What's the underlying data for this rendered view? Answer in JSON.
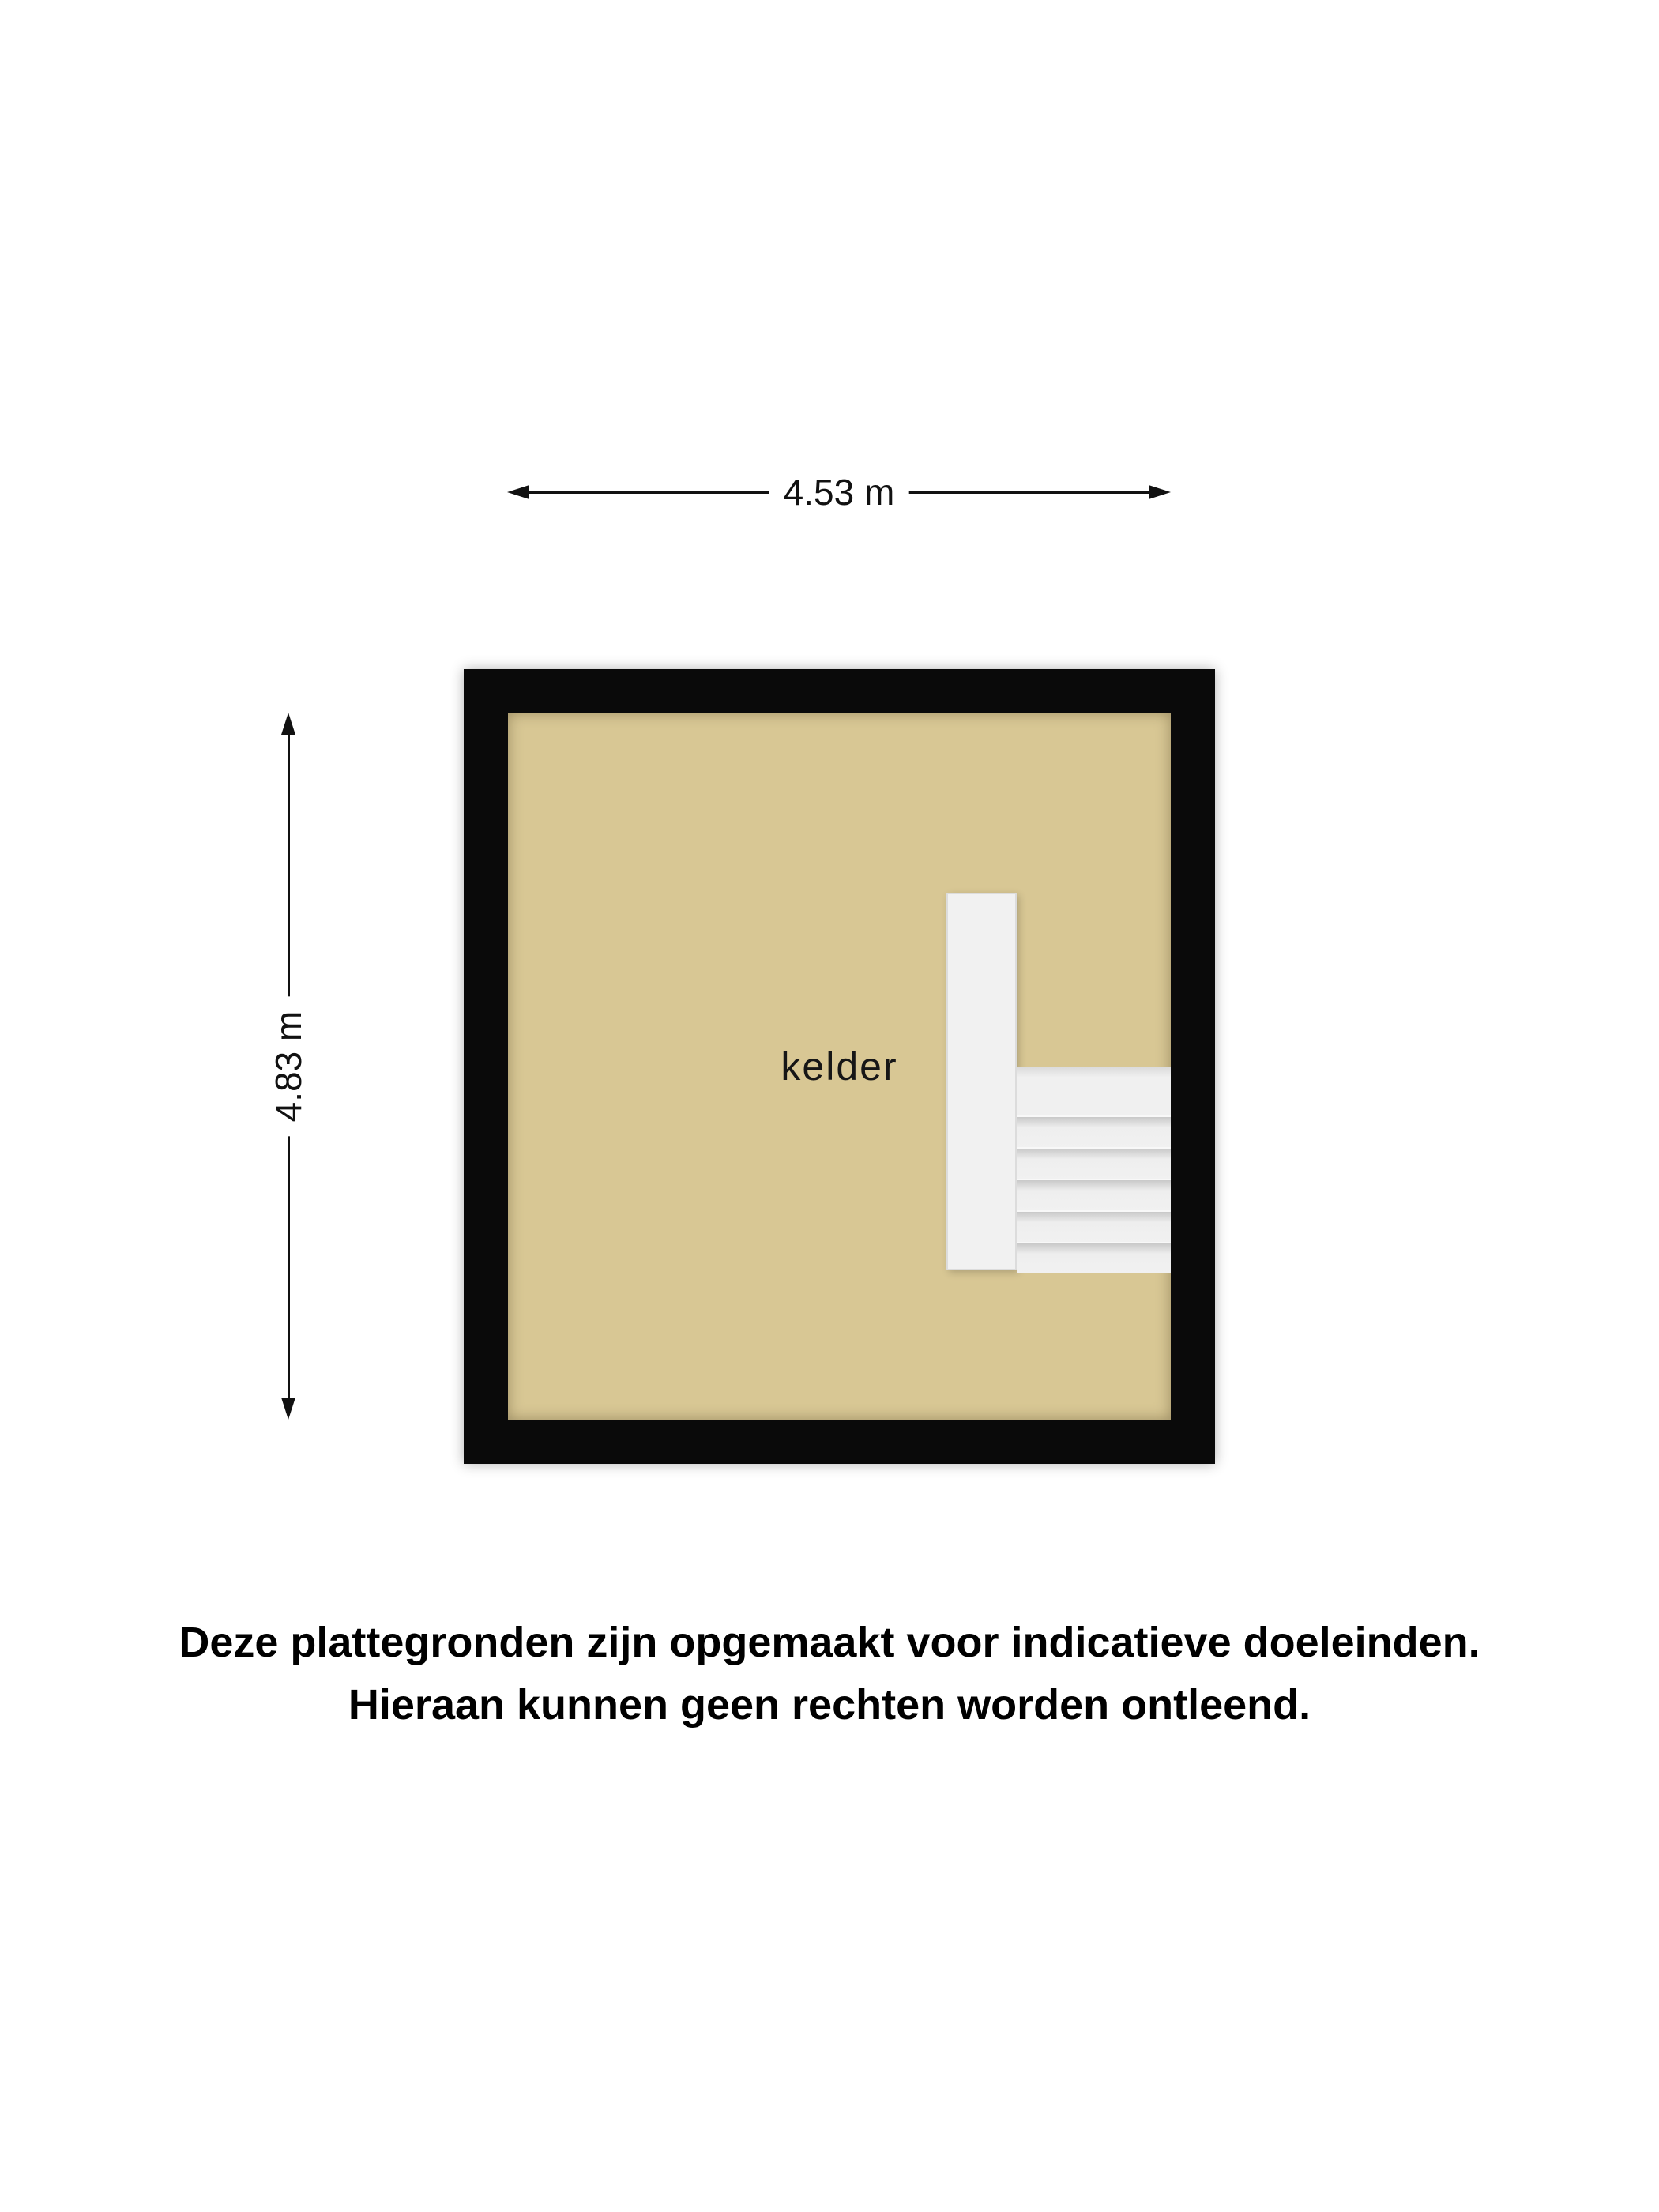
{
  "floorplan": {
    "room_label": "kelder",
    "dimensions": {
      "width": {
        "label": "4.53 m"
      },
      "height": {
        "label": "4.83 m"
      }
    },
    "stairs": {
      "steps": 6
    },
    "colors": {
      "wall": "#0a0a0a",
      "floor": "#d8c794",
      "stairs": "#f1f1f1",
      "dimension": "#111111",
      "background": "#ffffff"
    }
  },
  "disclaimer": {
    "line1": "Deze plattegronden zijn opgemaakt voor indicatieve doeleinden.",
    "line2": "Hieraan kunnen geen rechten worden ontleend."
  }
}
